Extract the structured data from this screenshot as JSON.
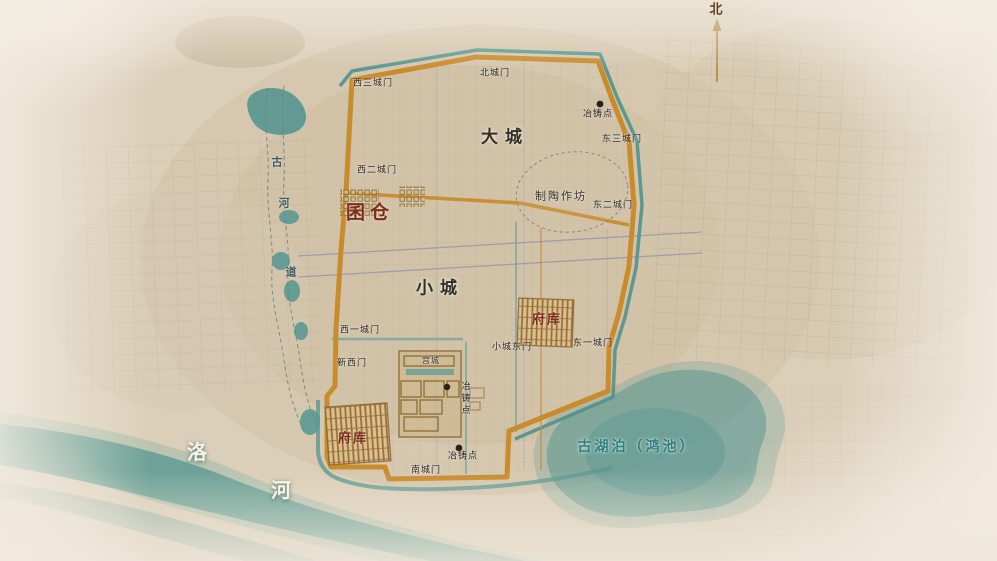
{
  "compass": {
    "north": "北"
  },
  "regions": {
    "great_city": "大城",
    "small_city": "小城",
    "palace_city": "宫城"
  },
  "sites": {
    "granary": "囷仓",
    "treasury_north": "府库",
    "treasury_south": "府库",
    "pottery_workshop": "制陶作坊",
    "smelting_site_ne": "冶铸点",
    "smelting_site_center": "冶铸点",
    "smelting_site_south": "冶铸点"
  },
  "gates": {
    "west_gate_3": "西三城门",
    "north_gate": "北城门",
    "east_gate_3": "东三城门",
    "west_gate_2": "西二城门",
    "east_gate_2": "东二城门",
    "west_gate_1": "西一城门",
    "small_city_east_gate": "小城东门",
    "east_gate_1": "东一城门",
    "new_west_gate": "新西门",
    "south_gate": "南城门"
  },
  "waters": {
    "ancient_channel_chars": [
      "古",
      "河",
      "道"
    ],
    "ancient_lake": "古湖泊（鸿池）",
    "luo_river_chars": [
      "洛",
      "河"
    ]
  },
  "colors": {
    "wall_orange": "#c8861f",
    "moat_teal": "#3f8e8c",
    "site_label_red": "#7b2d1a",
    "lake_text_teal": "#2e7f80",
    "ink": "#332d26",
    "background": "#ddd1bb"
  }
}
